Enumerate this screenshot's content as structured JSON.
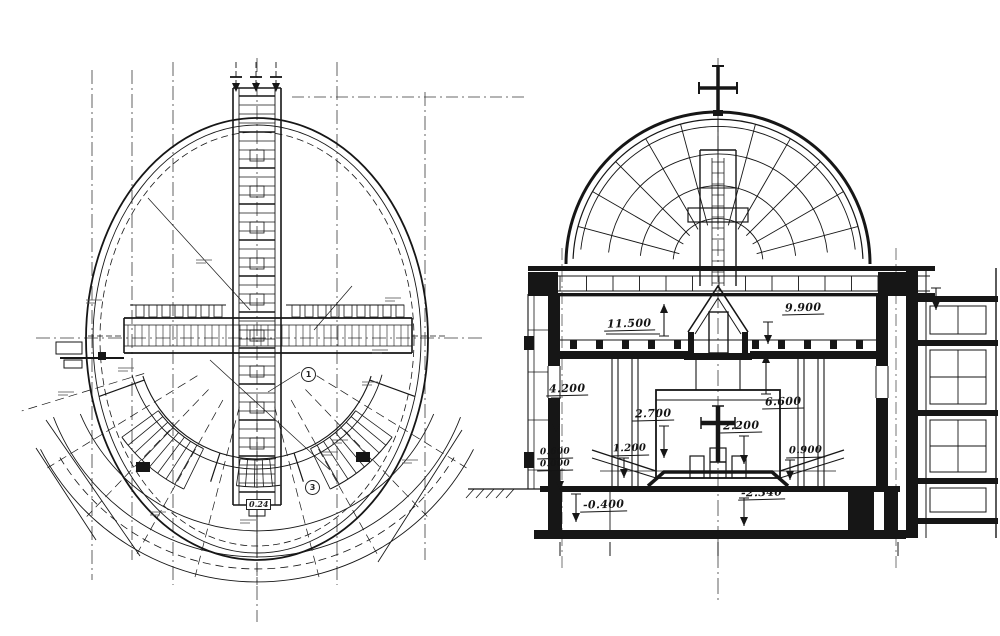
{
  "colors": {
    "ink": "#161616",
    "paper": "#ffffff",
    "grid": "#3a3a3a"
  },
  "plan": {
    "markers": [
      {
        "text": "1"
      },
      {
        "text": "3"
      }
    ],
    "boxed_label": {
      "text": "0.24"
    }
  },
  "section": {
    "dims": [
      {
        "text": "11.500"
      },
      {
        "text": "9.900"
      },
      {
        "text": "4.200"
      },
      {
        "text": "2.700"
      },
      {
        "text": "2.200"
      },
      {
        "text": "6.600"
      },
      {
        "text": "0.600"
      },
      {
        "text": "0.000"
      },
      {
        "text": "1.200"
      },
      {
        "text": "0.900"
      },
      {
        "text": "-0.400"
      },
      {
        "text": "-2.340"
      }
    ]
  }
}
